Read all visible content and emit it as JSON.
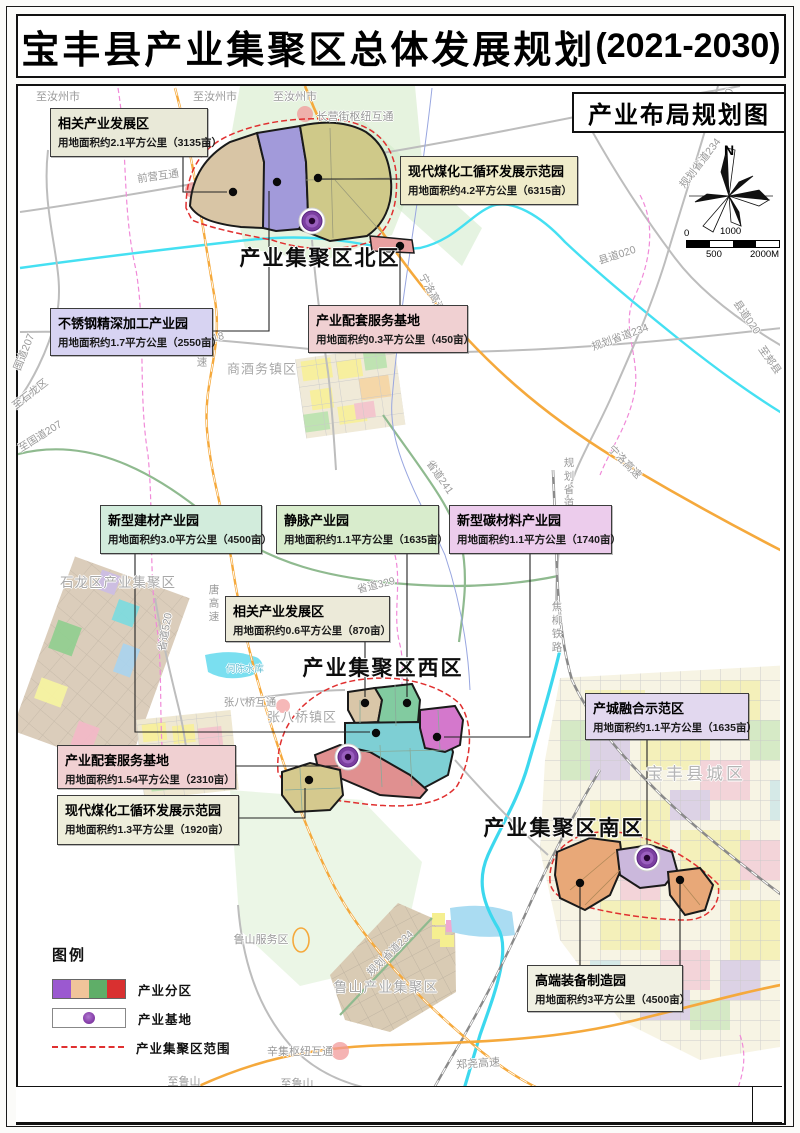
{
  "page": {
    "title_main": "宝丰县产业集聚区总体发展规划",
    "title_period": "(2021-2030)",
    "map_title": "产业布局规划图"
  },
  "compass": {
    "label": "N"
  },
  "scalebar": {
    "top_left": "0",
    "top_mid": "1000",
    "bottom_mid": "500",
    "bottom_right": "2000M"
  },
  "legend": {
    "title": "图例",
    "zone_colors": [
      "#9b59d0",
      "#f0c49a",
      "#5fae68",
      "#d93030"
    ],
    "items": [
      {
        "type": "swatches",
        "label": "产业分区"
      },
      {
        "type": "base",
        "label": "产业基地"
      },
      {
        "type": "dash",
        "label": "产业集聚区范围"
      }
    ]
  },
  "districts": [
    {
      "name": "产业集聚区北区",
      "x": 320,
      "y": 257
    },
    {
      "name": "产业集聚区西区",
      "x": 383,
      "y": 667
    },
    {
      "name": "产业集聚区南区",
      "x": 564,
      "y": 827
    }
  ],
  "callouts": [
    {
      "name": "相关产业发展区",
      "area": "用地面积约2.1平方公里（3135亩）",
      "fill": "#e9e9d8",
      "x": 50,
      "y": 108,
      "w": 158,
      "h": 49
    },
    {
      "name": "现代煤化工循环发展示范园",
      "area": "用地面积约4.2平方公里（6315亩）",
      "fill": "#f0eccb",
      "x": 400,
      "y": 156,
      "w": 178,
      "h": 49
    },
    {
      "name": "不锈钢精深加工产业园",
      "area": "用地面积约1.7平方公里（2550亩）",
      "fill": "#d7d3f2",
      "x": 50,
      "y": 308,
      "w": 163,
      "h": 48
    },
    {
      "name": "产业配套服务基地",
      "area": "用地面积约0.3平方公里（450亩）",
      "fill": "#f0d0d2",
      "x": 308,
      "y": 305,
      "w": 160,
      "h": 48
    },
    {
      "name": "新型建材产业园",
      "area": "用地面积约3.0平方公里（4500亩）",
      "fill": "#d2ecdc",
      "x": 100,
      "y": 505,
      "w": 162,
      "h": 49
    },
    {
      "name": "静脉产业园",
      "area": "用地面积约1.1平方公里（1635亩）",
      "fill": "#d8eccc",
      "x": 276,
      "y": 505,
      "w": 163,
      "h": 49
    },
    {
      "name": "新型碳材料产业园",
      "area": "用地面积约1.1平方公里（1740亩）",
      "fill": "#ecccec",
      "x": 449,
      "y": 505,
      "w": 163,
      "h": 49
    },
    {
      "name": "相关产业发展区",
      "area": "用地面积约0.6平方公里（870亩）",
      "fill": "#ecead9",
      "x": 225,
      "y": 596,
      "w": 165,
      "h": 46
    },
    {
      "name": "产城融合示范区",
      "area": "用地面积约1.1平方公里（1635亩）",
      "fill": "#e2d8ef",
      "x": 585,
      "y": 693,
      "w": 164,
      "h": 47
    },
    {
      "name": "产业配套服务基地",
      "area": "用地面积约1.54平方公里（2310亩）",
      "fill": "#f0d0d2",
      "x": 57,
      "y": 745,
      "w": 179,
      "h": 44
    },
    {
      "name": "现代煤化工循环发展示范园",
      "area": "用地面积约1.3平方公里（1920亩）",
      "fill": "#eeeedb",
      "x": 57,
      "y": 795,
      "w": 182,
      "h": 50
    },
    {
      "name": "高端装备制造园",
      "area": "用地面积约3平方公里（4500亩）",
      "fill": "#f0f0e2",
      "x": 527,
      "y": 965,
      "w": 156,
      "h": 47
    }
  ],
  "map_labels": [
    {
      "t": "至汝州市",
      "x": 58,
      "y": 96,
      "r": 0,
      "s": 11,
      "c": "road"
    },
    {
      "t": "至汝州市",
      "x": 215,
      "y": 96,
      "r": 0,
      "s": 11,
      "c": "road"
    },
    {
      "t": "至汝州市",
      "x": 295,
      "y": 96,
      "r": 0,
      "s": 11,
      "c": "road"
    },
    {
      "t": "长营街枢纽互通",
      "x": 355,
      "y": 116,
      "r": 0,
      "s": 11,
      "c": "road"
    },
    {
      "t": "县道030",
      "x": 724,
      "y": 107,
      "r": -72,
      "s": 10.5,
      "c": "road"
    },
    {
      "t": "规划省道234",
      "x": 700,
      "y": 163,
      "r": -52,
      "s": 10.5,
      "c": "road"
    },
    {
      "t": "前营互通",
      "x": 158,
      "y": 176,
      "r": -8,
      "s": 10.5,
      "c": "road"
    },
    {
      "t": "国道207",
      "x": 24,
      "y": 352,
      "r": -68,
      "s": 10.5,
      "c": "road"
    },
    {
      "t": "至石龙区",
      "x": 30,
      "y": 394,
      "r": -38,
      "s": 10.5,
      "c": "road"
    },
    {
      "t": "至国道207",
      "x": 40,
      "y": 436,
      "r": -32,
      "s": 10.5,
      "c": "road"
    },
    {
      "t": "县道018",
      "x": 205,
      "y": 340,
      "r": -14,
      "s": 10.5,
      "c": "road"
    },
    {
      "t": "县道018",
      "x": 416,
      "y": 347,
      "r": -4,
      "s": 10.5,
      "c": "road"
    },
    {
      "t": "宁洛高速",
      "x": 432,
      "y": 293,
      "r": 62,
      "s": 10.5,
      "c": "road"
    },
    {
      "t": "商酒务镇区",
      "x": 262,
      "y": 368,
      "r": 0,
      "s": 13,
      "c": "town"
    },
    {
      "t": "汝唐高速",
      "x": 202,
      "y": 343,
      "r": 0,
      "s": 10.5,
      "c": "road",
      "v": true
    },
    {
      "t": "唐高速",
      "x": 214,
      "y": 604,
      "r": 0,
      "s": 10.5,
      "c": "road",
      "v": true
    },
    {
      "t": "县道020",
      "x": 617,
      "y": 255,
      "r": -18,
      "s": 10.5,
      "c": "road"
    },
    {
      "t": "县道020",
      "x": 747,
      "y": 317,
      "r": 55,
      "s": 10.5,
      "c": "road"
    },
    {
      "t": "至郏县",
      "x": 770,
      "y": 360,
      "r": 55,
      "s": 10.5,
      "c": "road"
    },
    {
      "t": "规划省道234",
      "x": 620,
      "y": 337,
      "r": -20,
      "s": 10.5,
      "c": "road"
    },
    {
      "t": "宁洛高速",
      "x": 625,
      "y": 462,
      "r": 45,
      "s": 10.5,
      "c": "road"
    },
    {
      "t": "省道241",
      "x": 440,
      "y": 477,
      "r": 55,
      "s": 10.5,
      "c": "road"
    },
    {
      "t": "规划省道234",
      "x": 569,
      "y": 497,
      "r": 0,
      "s": 10.5,
      "c": "road",
      "v": true
    },
    {
      "t": "省道329",
      "x": 376,
      "y": 585,
      "r": -14,
      "s": 10.5,
      "c": "road"
    },
    {
      "t": "石龙区产业集聚区",
      "x": 118,
      "y": 581,
      "r": 0,
      "s": 13.5,
      "c": "town"
    },
    {
      "t": "省道520",
      "x": 165,
      "y": 632,
      "r": -80,
      "s": 10.5,
      "c": "road"
    },
    {
      "t": "何陈水库",
      "x": 245,
      "y": 668,
      "r": 0,
      "s": 9.5,
      "c": "water"
    },
    {
      "t": "张八桥互通",
      "x": 250,
      "y": 702,
      "r": 0,
      "s": 10.5,
      "c": "road"
    },
    {
      "t": "张八桥镇区",
      "x": 302,
      "y": 716,
      "r": 0,
      "s": 13,
      "c": "town"
    },
    {
      "t": "焦柳铁路",
      "x": 557,
      "y": 628,
      "r": 0,
      "s": 10.5,
      "c": "road",
      "v": true
    },
    {
      "t": "宝丰县城区",
      "x": 696,
      "y": 772,
      "r": 0,
      "s": 17,
      "c": "city"
    },
    {
      "t": "鲁山服务区",
      "x": 261,
      "y": 939,
      "r": 0,
      "s": 11,
      "c": "road"
    },
    {
      "t": "规划省道234",
      "x": 390,
      "y": 953,
      "r": -44,
      "s": 10.5,
      "c": "road"
    },
    {
      "t": "鲁山产业集聚区",
      "x": 386,
      "y": 987,
      "r": 0,
      "s": 14,
      "c": "town"
    },
    {
      "t": "辛集枢纽互通",
      "x": 300,
      "y": 1051,
      "r": 0,
      "s": 11,
      "c": "road"
    },
    {
      "t": "郑尧高速",
      "x": 478,
      "y": 1063,
      "r": -4,
      "s": 11,
      "c": "road"
    },
    {
      "t": "至鲁山",
      "x": 297,
      "y": 1083,
      "r": 0,
      "s": 11,
      "c": "road"
    },
    {
      "t": "至鲁山",
      "x": 184,
      "y": 1081,
      "r": 0,
      "s": 11,
      "c": "road"
    }
  ],
  "markers": {
    "bases": [
      [
        312,
        221
      ],
      [
        348,
        757
      ],
      [
        647,
        858
      ]
    ],
    "dots": [
      [
        233,
        192
      ],
      [
        277,
        182
      ],
      [
        318,
        178
      ],
      [
        400,
        246
      ],
      [
        365,
        703
      ],
      [
        407,
        703
      ],
      [
        376,
        733
      ],
      [
        437,
        737
      ],
      [
        309,
        780
      ],
      [
        580,
        883
      ],
      [
        680,
        880
      ]
    ]
  }
}
